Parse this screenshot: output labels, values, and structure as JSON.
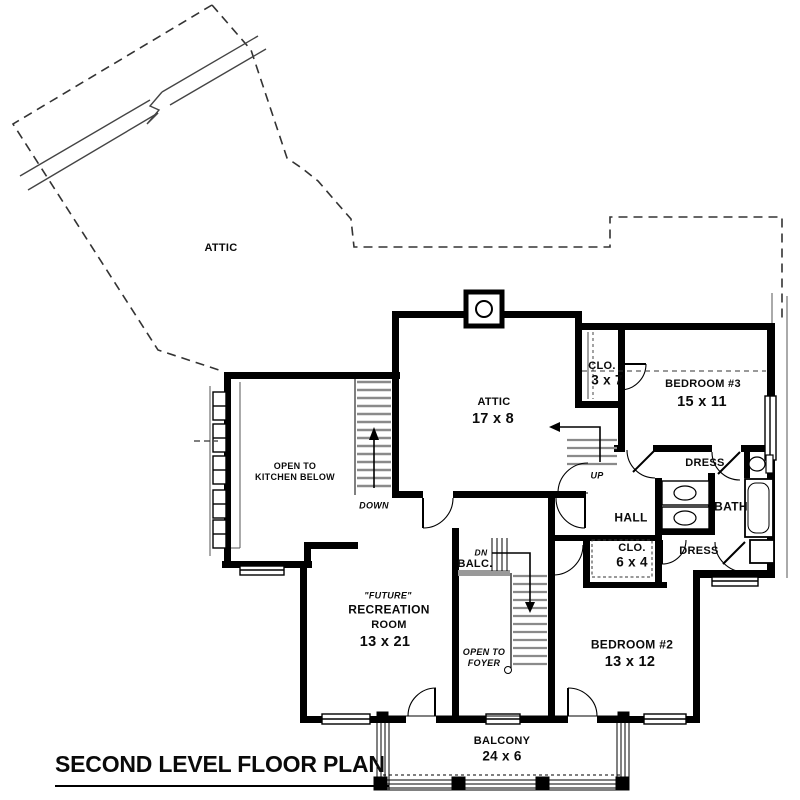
{
  "title": "SECOND LEVEL FLOOR PLAN",
  "rooms": {
    "attic_upper": {
      "name": "ATTIC"
    },
    "attic": {
      "name": "ATTIC",
      "dims": "17 x 8"
    },
    "closet_upper": {
      "name": "CLO.",
      "dims": "3 x 7"
    },
    "bedroom3": {
      "name": "BEDROOM #3",
      "dims": "15 x 11"
    },
    "open_to_kitchen": {
      "name": "OPEN TO\nKITCHEN BELOW"
    },
    "hall": {
      "name": "HALL"
    },
    "bath": {
      "name": "BATH"
    },
    "dressing_upper": {
      "name": "DRESS"
    },
    "dressing_lower": {
      "name": "DRESS"
    },
    "closet_lower": {
      "name": "CLO.",
      "dims": "6 x 4"
    },
    "bedroom2": {
      "name": "BEDROOM #2",
      "dims": "13 x 12"
    },
    "recreation": {
      "future": "\"FUTURE\"",
      "name": "RECREATION",
      "name2": "ROOM",
      "dims": "13 x 21"
    },
    "balcony_small": {
      "name": "BALC."
    },
    "open_to_foyer": {
      "name": "OPEN TO\nFOYER"
    },
    "balcony": {
      "name": "BALCONY",
      "dims": "24 x 6"
    }
  },
  "stairs": {
    "down": "DOWN",
    "up": "UP",
    "dn": "DN"
  },
  "colors": {
    "wall": "#000000",
    "tread_gray": "#8a8a8a",
    "rail_gray": "#999999",
    "background": "#ffffff"
  }
}
